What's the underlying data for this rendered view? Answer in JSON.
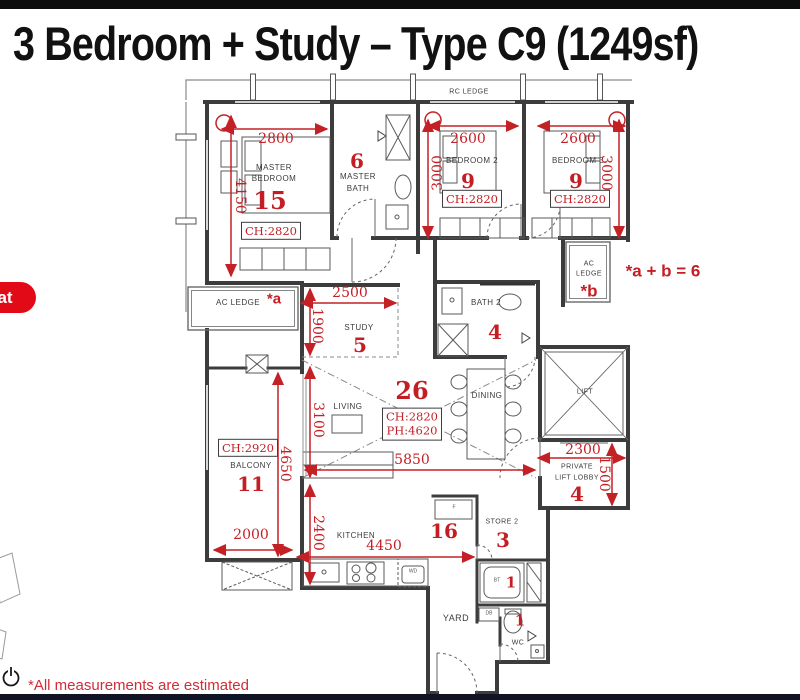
{
  "title": "3 Bedroom + Study – Type C9 (1249sf)",
  "badge": {
    "label": "at"
  },
  "footnote": "*All measurements are estimated",
  "formula": "*a + b = 6",
  "ledges": {
    "rc": "RC LEDGE",
    "ac_left": "AC LEDGE",
    "ac_left_tag": "*a",
    "ac_right_line1": "AC",
    "ac_right_line2": "LEDGE",
    "ac_right_tag": "*b"
  },
  "rooms": {
    "master_bedroom": {
      "line1": "MASTER",
      "line2": "BEDROOM",
      "number": "15",
      "ceiling": "CH:2820"
    },
    "master_bath": {
      "line1": "MASTER",
      "line2": "BATH",
      "number": "6"
    },
    "bedroom2": {
      "name": "BEDROOM 2",
      "number": "9",
      "ceiling": "CH:2820"
    },
    "bedroom3": {
      "name": "BEDROOM 3",
      "number": "9",
      "ceiling": "CH:2820"
    },
    "study": {
      "name": "STUDY",
      "number": "5"
    },
    "bath2": {
      "name": "BATH 2",
      "number": "4"
    },
    "living": {
      "name": "LIVING",
      "number": "26",
      "ceiling": "CH:2820",
      "party": "PH:4620"
    },
    "dining": {
      "name": "DINING"
    },
    "lift": {
      "name": "LIFT"
    },
    "lobby": {
      "line1": "PRIVATE",
      "line2": "LIFT LOBBY",
      "number": "4"
    },
    "balcony": {
      "name": "BALCONY",
      "number": "11",
      "ceiling": "CH:2920"
    },
    "kitchen": {
      "name": "KITCHEN",
      "number": "16"
    },
    "store2": {
      "name": "STORE 2",
      "number": "3"
    },
    "yard": {
      "name": "YARD"
    },
    "wc": {
      "name": "WC",
      "number": "1"
    },
    "bath3": {
      "number": "1"
    }
  },
  "fixtures": {
    "wd": "WD",
    "fridge": "F",
    "bt": "BT",
    "db": "DB"
  },
  "dimensions": {
    "master_w": "2800",
    "master_h": "4150",
    "bed2_w": "2600",
    "bed2_h": "3000",
    "bed3_w": "2600",
    "bed3_h": "3000",
    "study_w": "2500",
    "study_h": "1900",
    "living_h": "3100",
    "living_w": "5850",
    "balcony_h": "4650",
    "balcony_w": "2000",
    "kitchen_h": "2400",
    "kitchen_w": "4450",
    "lobby_w": "2300",
    "lobby_h": "1500"
  },
  "colors": {
    "dimension_red": "#c42127",
    "number_red": "#c41e24",
    "badge_red": "#e20a17",
    "wall": "#3c3c3c"
  }
}
